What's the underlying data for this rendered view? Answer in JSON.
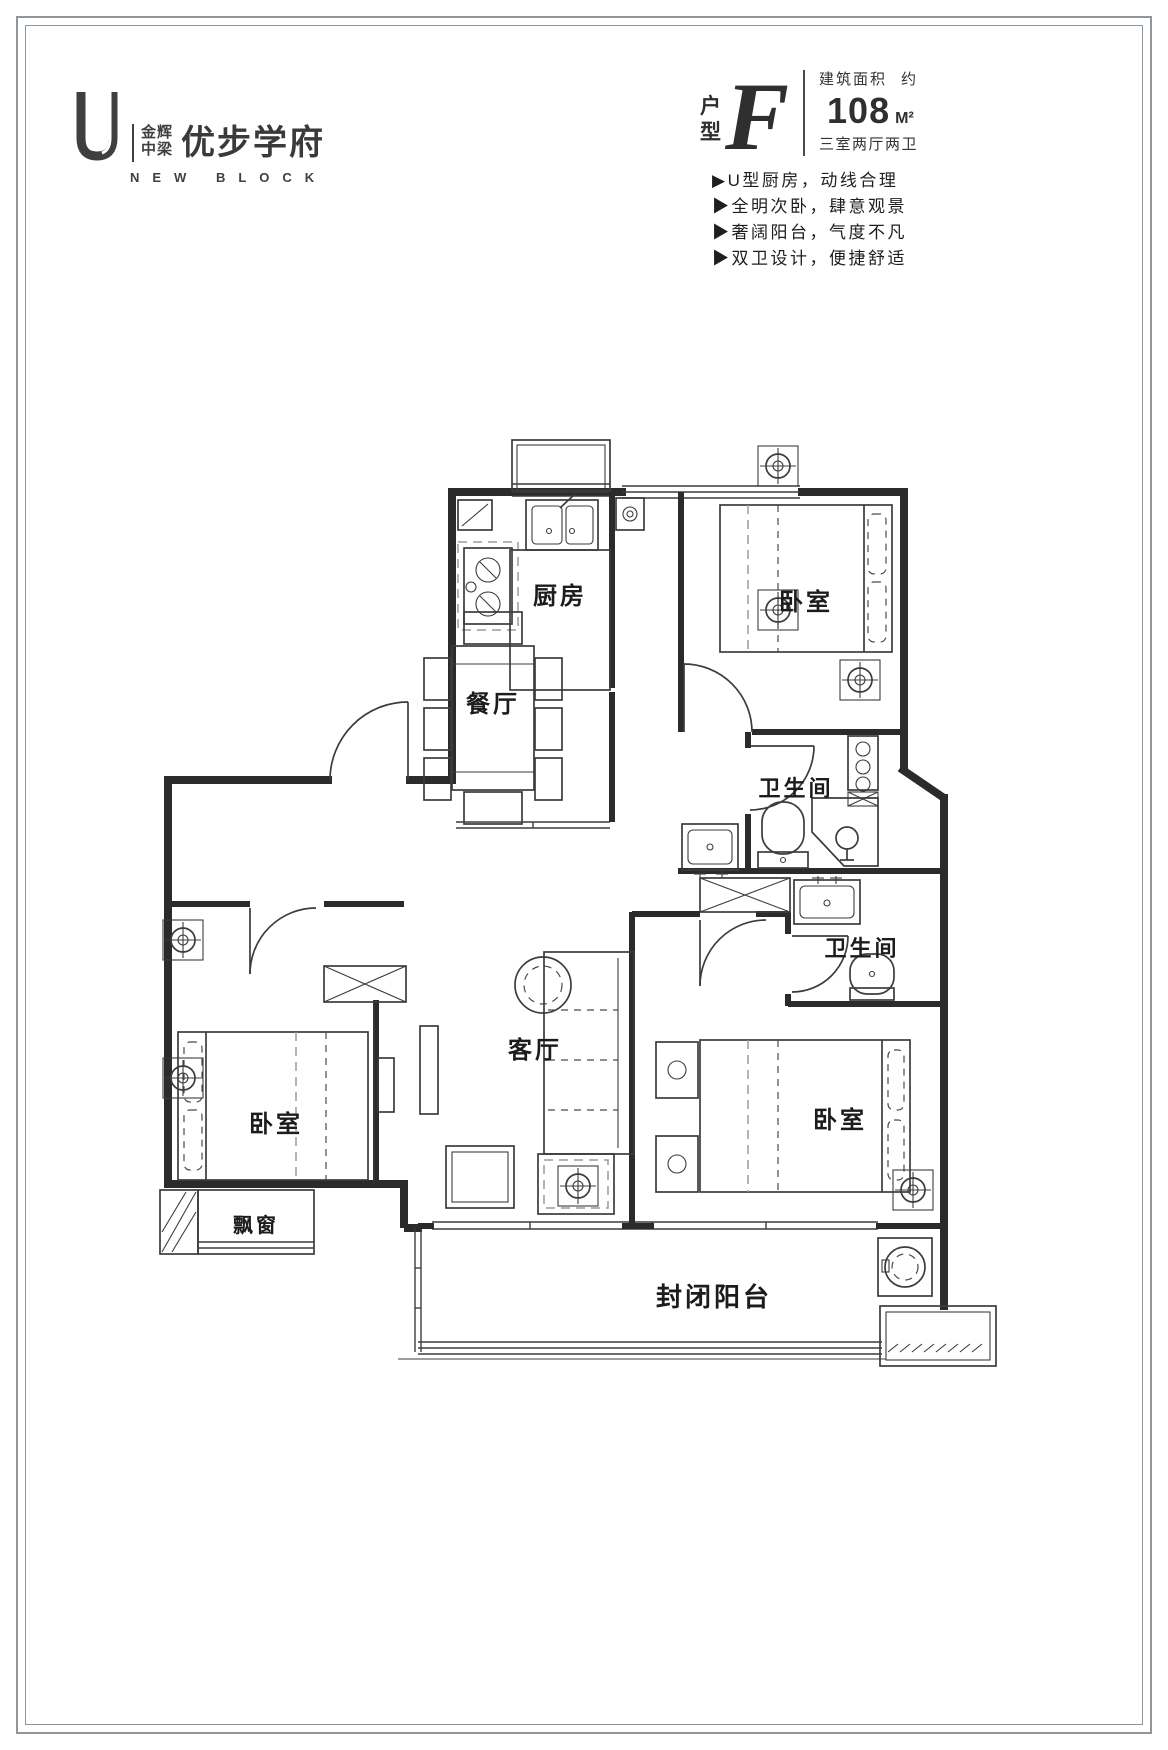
{
  "brand": {
    "logo_letter": "U",
    "name_line1": "金辉",
    "name_line2": "中梁",
    "name_main": "优步学府",
    "name_en": "NEW BLOCK"
  },
  "unit": {
    "type_char1": "户",
    "type_char2": "型",
    "letter": "F",
    "area_label": "建筑面积",
    "area_approx": "约",
    "area_value": "108",
    "area_unit": "M²",
    "layout_desc": "三室两厅两卫"
  },
  "features": {
    "items": [
      "▶U型厨房，动线合理",
      "▶全明次卧，肆意观景",
      "▶奢阔阳台，气度不凡",
      "▶双卫设计，便捷舒适"
    ]
  },
  "floorplan": {
    "labels": {
      "kitchen": "厨房",
      "bedroom_top": "卧室",
      "bath_1": "卫生间",
      "dining": "餐厅",
      "living": "客厅",
      "bedroom_left": "卧室",
      "bedroom_right": "卧室",
      "bath_2": "卫生间",
      "bay_window": "飘窗",
      "balcony": "封闭阳台"
    }
  },
  "colors": {
    "wall": "#2b2b2b",
    "frame": "#8f979c",
    "dash": "#9b9b9b",
    "text": "#1c1c1c"
  }
}
